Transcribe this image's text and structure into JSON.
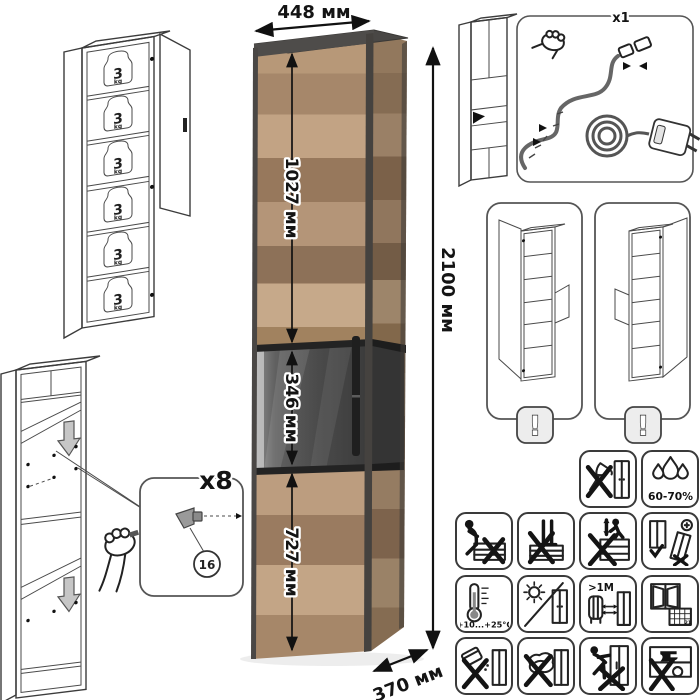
{
  "dimensions": {
    "width": "448 мм",
    "height": "2100 мм",
    "depth": "370 мм",
    "upper_section": "1027 мм",
    "middle_section": "346 мм",
    "lower_section": "727 мм"
  },
  "shelf_load": {
    "value": "3",
    "unit": "kg",
    "shelf_count": 6
  },
  "assembly": {
    "pin_count_label": "x8",
    "part_number": "16"
  },
  "led_kit": {
    "count_label": "x1"
  },
  "door_variants": {
    "warning_mark": "!"
  },
  "care": {
    "humidity_label": "60-70%",
    "temperature_label": "+10...+25°C",
    "heater_distance_label": ">1M",
    "calendar_day": "21"
  },
  "colors": {
    "wood_light": "#c2a384",
    "wood_dark": "#97785c",
    "graphite": "#494745",
    "outline": "#3c3c3c",
    "shelf_gray": "#bdbdbd",
    "glass_gray": "#4a4a4a"
  },
  "icons": {
    "grid": [
      "no-sharp-tools-icon",
      "humidity-icon",
      "no-sitting-icon",
      "no-standing-icon",
      "no-climbing-icon",
      "anchor-warning-icon",
      "temperature-icon",
      "no-direct-sunlight-icon",
      "heater-distance-icon",
      "ventilation-icon",
      "no-liquids-icon",
      "no-wet-cleaning-icon",
      "no-dragging-icon",
      "no-heavy-load-icon"
    ],
    "other": [
      "weight-3kg-icon",
      "shelf-pin-icon",
      "hand-icon",
      "power-adapter-icon",
      "led-strip-icon",
      "warning-exclamation-icon",
      "down-arrow-icon"
    ]
  }
}
